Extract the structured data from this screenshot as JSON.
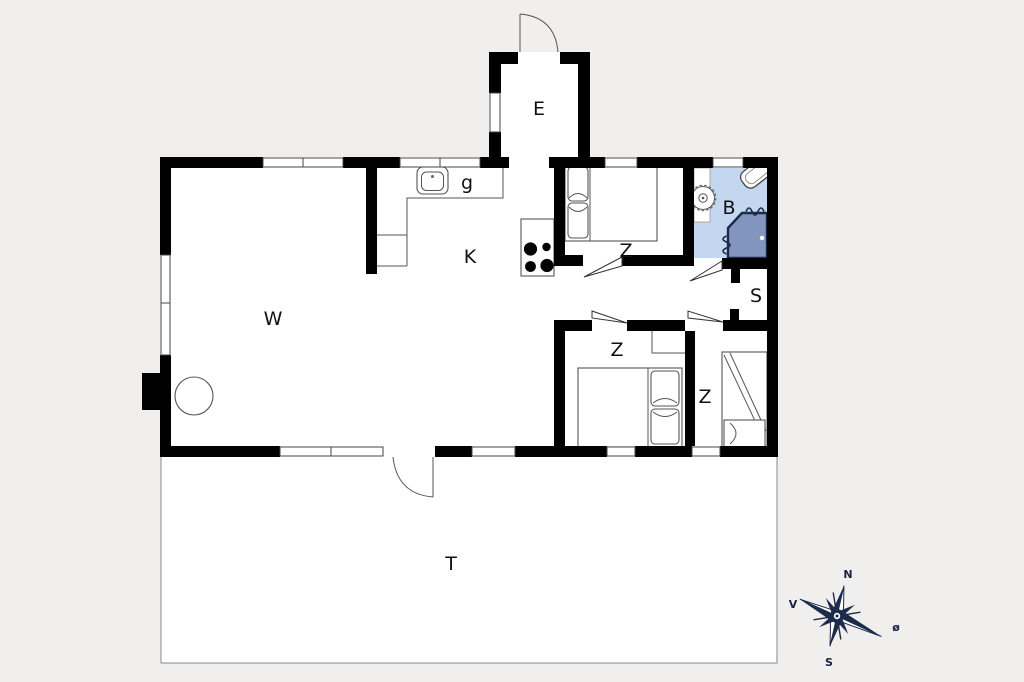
{
  "floorplan": {
    "title": "holiday-house-floor-plan",
    "rooms": [
      {
        "id": "living-room",
        "label": "W"
      },
      {
        "id": "kitchen",
        "label": "K"
      },
      {
        "id": "kitchen-sink-area",
        "label": "g"
      },
      {
        "id": "entrance",
        "label": "E"
      },
      {
        "id": "bedroom-1",
        "label": "Z"
      },
      {
        "id": "bathroom",
        "label": "B"
      },
      {
        "id": "hallway",
        "label": "S"
      },
      {
        "id": "bedroom-2",
        "label": "Z"
      },
      {
        "id": "bedroom-3",
        "label": "Z"
      },
      {
        "id": "terrace",
        "label": "T"
      }
    ],
    "compass": {
      "north": "N",
      "west": "V",
      "east": "ø",
      "south": "S"
    },
    "palette": {
      "background": "#f0efee",
      "room_fill": "#ffffff",
      "wall": "#000000",
      "bathroom_fill": "#c3d8f0",
      "shower_fill": "#8195bf",
      "compass_navy": "#1c2b4a"
    }
  }
}
